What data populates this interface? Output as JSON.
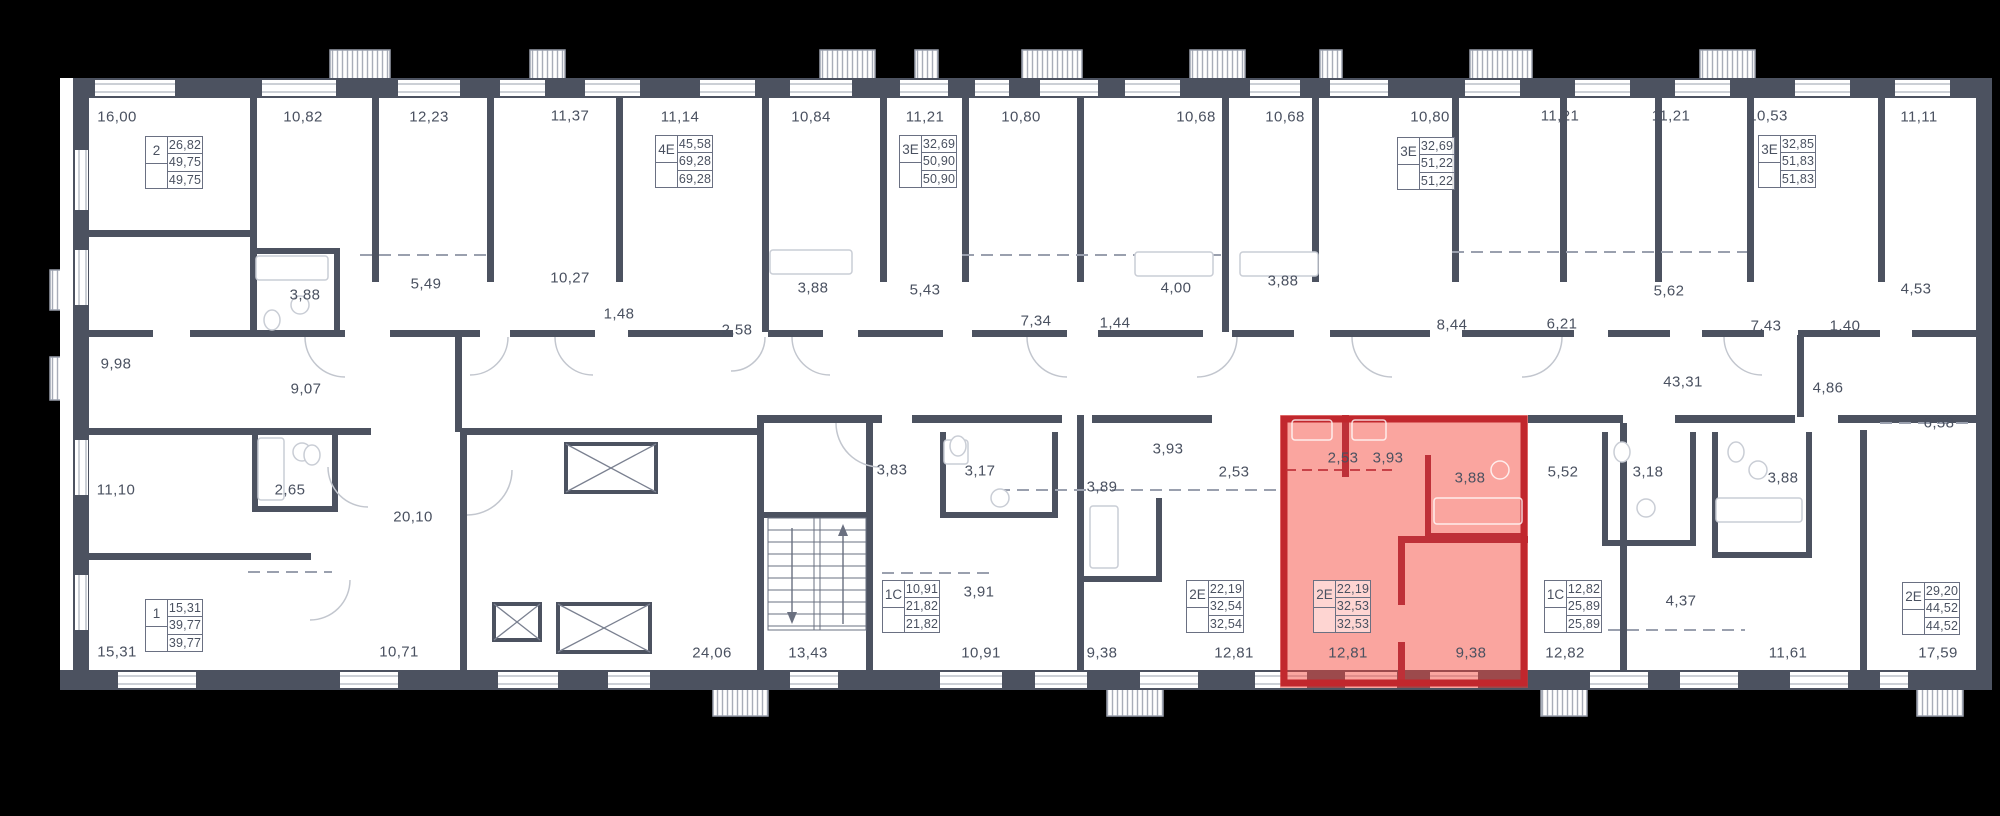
{
  "colors": {
    "background": "#000000",
    "paper": "#FFFFFF",
    "walls": "#4C5260",
    "text": "#4A5160",
    "highlight_fill": "#F44336",
    "highlight_outline": "#C1272D"
  },
  "selected_apartment": {
    "type": "2Е",
    "values": [
      "22,19",
      "32,53",
      "32,53"
    ],
    "room_areas": [
      "2,53",
      "3,93",
      "3,88",
      "12,81",
      "9,38"
    ]
  },
  "apartment_cards": [
    {
      "type": "2",
      "values": [
        "26,82",
        "49,75",
        "49,75"
      ],
      "x": 145,
      "y": 136,
      "selected": false
    },
    {
      "type": "4Е",
      "values": [
        "45,58",
        "69,28",
        "69,28"
      ],
      "x": 655,
      "y": 135,
      "selected": false
    },
    {
      "type": "3Е",
      "values": [
        "32,69",
        "50,90",
        "50,90"
      ],
      "x": 899,
      "y": 135,
      "selected": false
    },
    {
      "type": "3Е",
      "values": [
        "32,69",
        "51,22",
        "51,22"
      ],
      "x": 1397,
      "y": 137,
      "selected": false
    },
    {
      "type": "3Е",
      "values": [
        "32,85",
        "51,83",
        "51,83"
      ],
      "x": 1758,
      "y": 135,
      "selected": false
    },
    {
      "type": "1",
      "values": [
        "15,31",
        "39,77",
        "39,77"
      ],
      "x": 145,
      "y": 599,
      "selected": false
    },
    {
      "type": "1С",
      "values": [
        "10,91",
        "21,82",
        "21,82"
      ],
      "x": 882,
      "y": 580,
      "selected": false
    },
    {
      "type": "2Е",
      "values": [
        "22,19",
        "32,54",
        "32,54"
      ],
      "x": 1186,
      "y": 580,
      "selected": false
    },
    {
      "type": "2Е",
      "values": [
        "22,19",
        "32,53",
        "32,53"
      ],
      "x": 1313,
      "y": 580,
      "selected": true
    },
    {
      "type": "1С",
      "values": [
        "12,82",
        "25,89",
        "25,89"
      ],
      "x": 1544,
      "y": 580,
      "selected": false
    },
    {
      "type": "2Е",
      "values": [
        "29,20",
        "44,52",
        "44,52"
      ],
      "x": 1902,
      "y": 582,
      "selected": false
    }
  ],
  "room_labels": [
    {
      "t": "16,00",
      "x": 117,
      "y": 117
    },
    {
      "t": "10,82",
      "x": 303,
      "y": 117
    },
    {
      "t": "12,23",
      "x": 429,
      "y": 117
    },
    {
      "t": "11,37",
      "x": 570,
      "y": 116
    },
    {
      "t": "11,14",
      "x": 680,
      "y": 117
    },
    {
      "t": "10,84",
      "x": 811,
      "y": 117
    },
    {
      "t": "11,21",
      "x": 925,
      "y": 117
    },
    {
      "t": "10,80",
      "x": 1021,
      "y": 117
    },
    {
      "t": "10,68",
      "x": 1196,
      "y": 117
    },
    {
      "t": "10,68",
      "x": 1285,
      "y": 117
    },
    {
      "t": "10,80",
      "x": 1430,
      "y": 117
    },
    {
      "t": "11,21",
      "x": 1560,
      "y": 116
    },
    {
      "t": "11,21",
      "x": 1671,
      "y": 116
    },
    {
      "t": "10,53",
      "x": 1768,
      "y": 116
    },
    {
      "t": "11,11",
      "x": 1919,
      "y": 117
    },
    {
      "t": "3,88",
      "x": 305,
      "y": 295
    },
    {
      "t": "5,49",
      "x": 426,
      "y": 284
    },
    {
      "t": "10,27",
      "x": 570,
      "y": 278
    },
    {
      "t": "1,48",
      "x": 619,
      "y": 314
    },
    {
      "t": "2,58",
      "x": 737,
      "y": 330
    },
    {
      "t": "3,88",
      "x": 813,
      "y": 288
    },
    {
      "t": "5,43",
      "x": 925,
      "y": 290
    },
    {
      "t": "7,34",
      "x": 1036,
      "y": 321
    },
    {
      "t": "1,44",
      "x": 1115,
      "y": 323
    },
    {
      "t": "4,00",
      "x": 1176,
      "y": 288
    },
    {
      "t": "3,88",
      "x": 1283,
      "y": 281
    },
    {
      "t": "8,44",
      "x": 1452,
      "y": 325
    },
    {
      "t": "6,21",
      "x": 1562,
      "y": 324
    },
    {
      "t": "5,62",
      "x": 1669,
      "y": 291
    },
    {
      "t": "7,43",
      "x": 1766,
      "y": 326
    },
    {
      "t": "1,40",
      "x": 1845,
      "y": 326
    },
    {
      "t": "4,53",
      "x": 1916,
      "y": 289
    },
    {
      "t": "43,31",
      "x": 1683,
      "y": 382
    },
    {
      "t": "4,86",
      "x": 1828,
      "y": 388
    },
    {
      "t": "6,58",
      "x": 1939,
      "y": 423
    },
    {
      "t": "9,98",
      "x": 116,
      "y": 364
    },
    {
      "t": "9,07",
      "x": 306,
      "y": 389
    },
    {
      "t": "11,10",
      "x": 116,
      "y": 490
    },
    {
      "t": "2,65",
      "x": 290,
      "y": 490
    },
    {
      "t": "20,10",
      "x": 413,
      "y": 517
    },
    {
      "t": "3,83",
      "x": 892,
      "y": 470
    },
    {
      "t": "3,17",
      "x": 980,
      "y": 471
    },
    {
      "t": "3,89",
      "x": 1102,
      "y": 487
    },
    {
      "t": "3,93",
      "x": 1168,
      "y": 449
    },
    {
      "t": "2,53",
      "x": 1234,
      "y": 472
    },
    {
      "t": "2,53",
      "x": 1343,
      "y": 458
    },
    {
      "t": "3,93",
      "x": 1388,
      "y": 458
    },
    {
      "t": "3,88",
      "x": 1470,
      "y": 478
    },
    {
      "t": "5,52",
      "x": 1563,
      "y": 472
    },
    {
      "t": "3,18",
      "x": 1648,
      "y": 472
    },
    {
      "t": "3,88",
      "x": 1783,
      "y": 478
    },
    {
      "t": "15,31",
      "x": 117,
      "y": 652
    },
    {
      "t": "10,71",
      "x": 399,
      "y": 652
    },
    {
      "t": "24,06",
      "x": 712,
      "y": 653
    },
    {
      "t": "13,43",
      "x": 808,
      "y": 653
    },
    {
      "t": "3,91",
      "x": 979,
      "y": 592
    },
    {
      "t": "10,91",
      "x": 981,
      "y": 653
    },
    {
      "t": "9,38",
      "x": 1102,
      "y": 653
    },
    {
      "t": "12,81",
      "x": 1234,
      "y": 653
    },
    {
      "t": "12,81",
      "x": 1348,
      "y": 653
    },
    {
      "t": "9,38",
      "x": 1471,
      "y": 653
    },
    {
      "t": "12,82",
      "x": 1565,
      "y": 653
    },
    {
      "t": "4,37",
      "x": 1681,
      "y": 601
    },
    {
      "t": "11,61",
      "x": 1788,
      "y": 653
    },
    {
      "t": "17,59",
      "x": 1938,
      "y": 653
    }
  ]
}
